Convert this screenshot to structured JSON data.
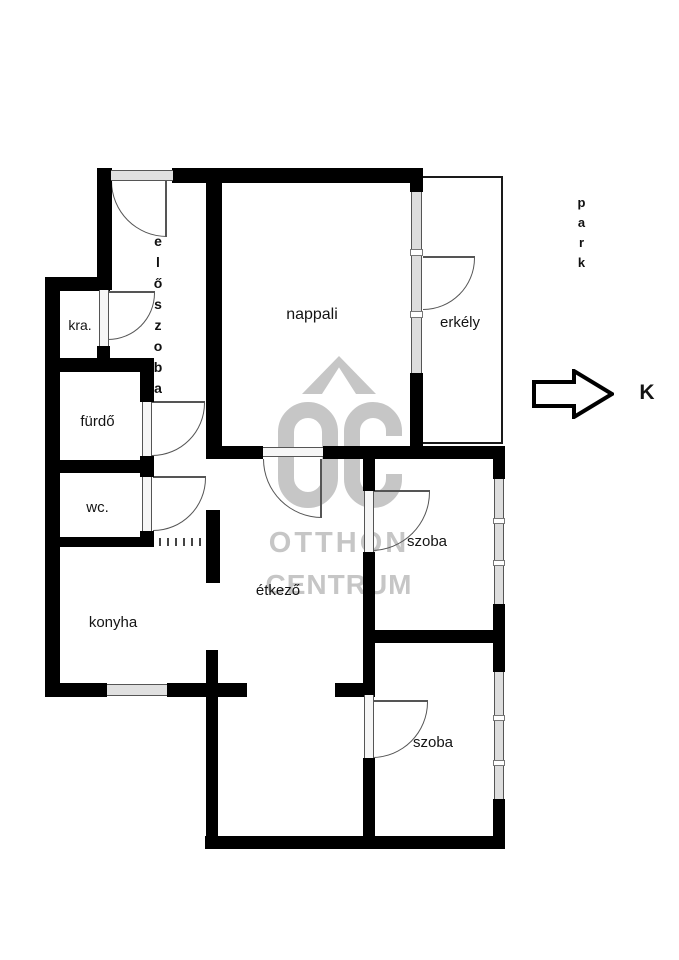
{
  "plan": {
    "rooms": {
      "eloszoba": "előszoba",
      "kamra": "kra.",
      "furdo": "fürdő",
      "wc": "wc.",
      "konyha": "konyha",
      "etkezo": "étkező",
      "nappali": "nappali",
      "erkely": "erkély",
      "szoba_felso": "szoba",
      "szoba_also": "szoba"
    },
    "outside": {
      "park": "park",
      "compass_direction": "K"
    }
  },
  "watermark": {
    "logo": "OC",
    "line1": "OTTHON",
    "line2": "CENTRUM"
  },
  "colors": {
    "wall": "#000000",
    "thin_line": "#555555",
    "watermark": "#c6c6c6",
    "background": "#ffffff"
  }
}
